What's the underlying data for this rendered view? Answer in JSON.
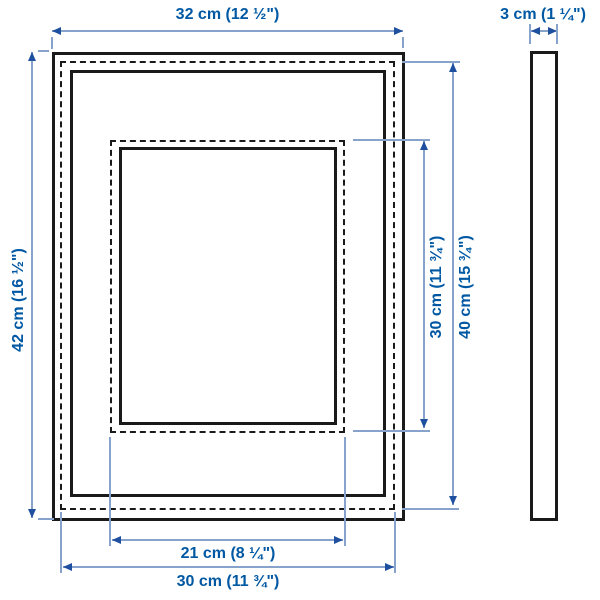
{
  "diagram_type": "picture-frame-dimension-drawing",
  "colors": {
    "label": "#0058a3",
    "dim_line": "#87a3cb",
    "dim_arrow": "#1f4f9f",
    "frame": "#1a1a1a",
    "background": "#ffffff"
  },
  "dimensions": {
    "outer_width": "32 cm (12 ½\")",
    "depth": "3 cm (1 ¼\")",
    "outer_height": "42 cm (16 ½\")",
    "picture_height_with_mat": "30 cm (11 ¾\")",
    "picture_height_without_mat": "40 cm (15 ¾\")",
    "picture_width_with_mat": "21 cm (8 ¼\")",
    "picture_width_without_mat": "30 cm (11 ¾\")"
  }
}
